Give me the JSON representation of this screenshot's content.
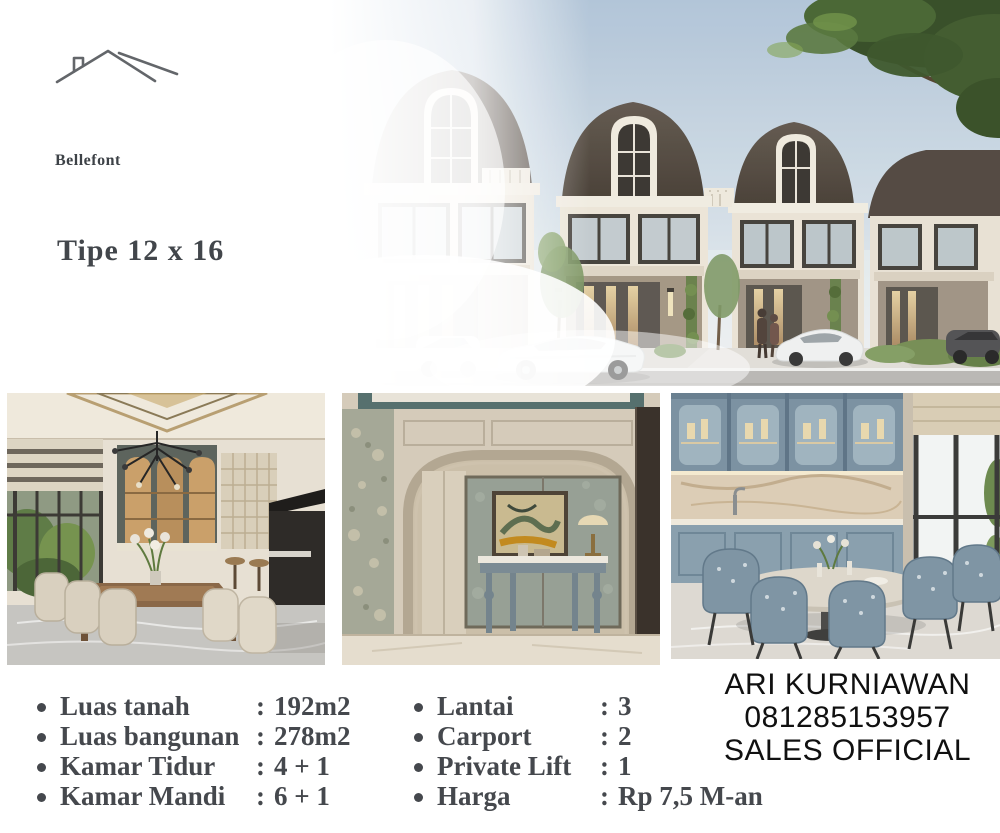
{
  "brand": {
    "title": "Bellefont",
    "subtitle": "Tipe 12 x 16",
    "logo_icon": "roofline-icon"
  },
  "specs": {
    "separator": ":",
    "left": [
      {
        "label": "Luas tanah",
        "value": "192m2"
      },
      {
        "label": "Luas bangunan",
        "value": "278m2"
      },
      {
        "label": "Kamar Tidur",
        "value": "4 + 1"
      },
      {
        "label": "Kamar Mandi",
        "value": "6 + 1"
      }
    ],
    "right": [
      {
        "label": "Lantai",
        "value": "3"
      },
      {
        "label": "Carport",
        "value": "2"
      },
      {
        "label": "Private Lift",
        "value": "1"
      },
      {
        "label": "Harga",
        "value": "Rp 7,5 M-an"
      }
    ]
  },
  "contact": {
    "name": "ARI KURNIAWAN",
    "phone": "081285153957",
    "role": "SALES OFFICIAL"
  },
  "photos": [
    {
      "name": "exterior-townhouse-render"
    },
    {
      "name": "dining-room-interior"
    },
    {
      "name": "foyer-interior"
    },
    {
      "name": "kitchen-dining-interior"
    }
  ],
  "colors": {
    "background": "#ffffff",
    "title_text": "#3d4247",
    "specs_text": "#45484d",
    "contact_text": "#101010",
    "sky": "#b2c5d8",
    "roof": "#55493f",
    "facade": "#eae3d6",
    "tree_green": "#2f471f"
  }
}
